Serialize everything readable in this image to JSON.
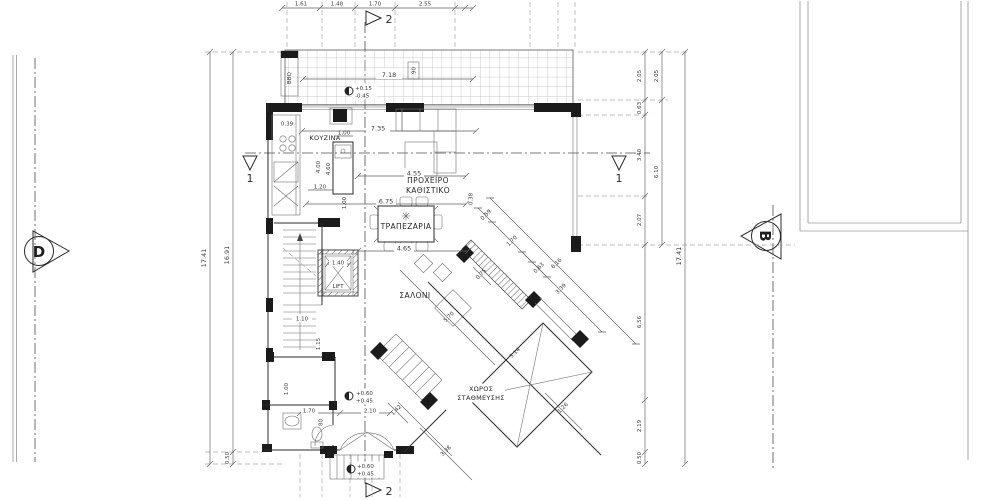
{
  "drawing_title": "ground-floor-plan",
  "colors": {
    "ink": "#2b2b2b",
    "light_line": "#a8a8a8",
    "paper": "#ffffff"
  },
  "rooms": {
    "kitchen": "ΚΟΥΖΙΝΑ",
    "sitting1": "ΠΡΟΧΕΙΡΟ",
    "sitting2": "ΚΑΘΙΣΤΙΚΟ",
    "dining": "ΤΡΑΠΕΖΑΡΙΑ",
    "living": "ΣΑΛΟΝΙ",
    "lift": "LIFT",
    "parking1": "ΧΩΡΟΣ",
    "parking2": "ΣΤΑΘΜΕΥΣΗΣ",
    "bbq": "BBQ"
  },
  "markers": {
    "elevation_left": "D",
    "elevation_right": "B",
    "section1": "1",
    "section2": "2"
  },
  "levels": {
    "veranda_upper": "+0.15",
    "veranda_lower": "-0.45",
    "hall_upper": "+0.60",
    "hall_lower": "+0.45",
    "entry_upper": "+0.60",
    "entry_lower": "+0.45"
  },
  "tags": {
    "window": "90"
  },
  "dims": {
    "top1": "1.61",
    "top2": "1.48",
    "top3": "1.70",
    "top4": "2.55",
    "veranda_w": "7.18",
    "k1": "0.39",
    "k2": "7.35",
    "k3": "1.00",
    "k4": "4.00",
    "k5": "4.60",
    "k6": "1.20",
    "k7": "1.00",
    "s1": "4.55",
    "s2": "0.38",
    "d1": "6.75",
    "d2": "4.65",
    "lift_w": "1.40",
    "st1": "1.10",
    "st2": "1.15",
    "st3": "1.00",
    "w1": "1.70",
    "w2": "80",
    "w3": "2.10",
    "dg1": "0.59",
    "dg2": "1.70",
    "dg3": "0.63",
    "dg4": "6.16",
    "dg5": "3.39",
    "g1": "5.70",
    "g2": "3.14",
    "g3": "0.75",
    "g4": "1.26",
    "g5": "3.38",
    "g6": "1.42",
    "ra1": "2.05",
    "ra2": "0.63",
    "ra3": "3.40",
    "ra4": "2.07",
    "ra5": "6.56",
    "ra6": "2.19",
    "ra7": "0.50",
    "rb1": "2.05",
    "rb2": "6.10",
    "rc1": "17.41",
    "la1": "17.41",
    "lb1": "16.91",
    "lb2": "0.50"
  }
}
